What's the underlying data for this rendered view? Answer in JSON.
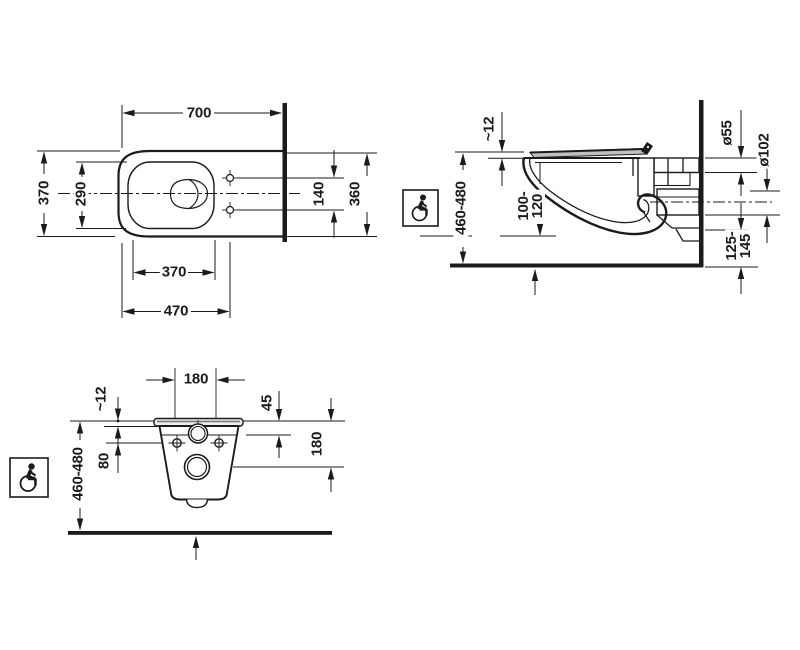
{
  "drawing": {
    "type": "technical-installation-drawing",
    "views": {
      "top": {
        "labels": {
          "overall_depth": "700",
          "overall_width": "370",
          "bowl_inner_width": "290",
          "holes_spacing": "140",
          "body_back_width": "360",
          "bowl_inner_depth": "370",
          "front_to_holes": "470"
        }
      },
      "side": {
        "labels": {
          "seat_thickness": "~12",
          "seat_height": "460-480",
          "rim_clearance_line1": "100-",
          "rim_clearance_line2": "120",
          "inlet_diameter": "ø55",
          "outlet_diameter": "ø102",
          "outlet_height_line1": "125-",
          "outlet_height_line2": "145"
        }
      },
      "rear": {
        "labels": {
          "holes_spacing": "180",
          "seat_thickness": "~12",
          "top_to_inlet": "45",
          "top_to_holes": "80",
          "top_to_outlet": "180",
          "seat_height": "460-480"
        }
      }
    },
    "icons": {
      "side_accessibility": "wheelchair-icon",
      "rear_accessibility": "wheelchair-icon"
    },
    "colors": {
      "line": "#1b1b1b",
      "background": "#ffffff",
      "seat_fill": "#c0c0c0"
    }
  }
}
